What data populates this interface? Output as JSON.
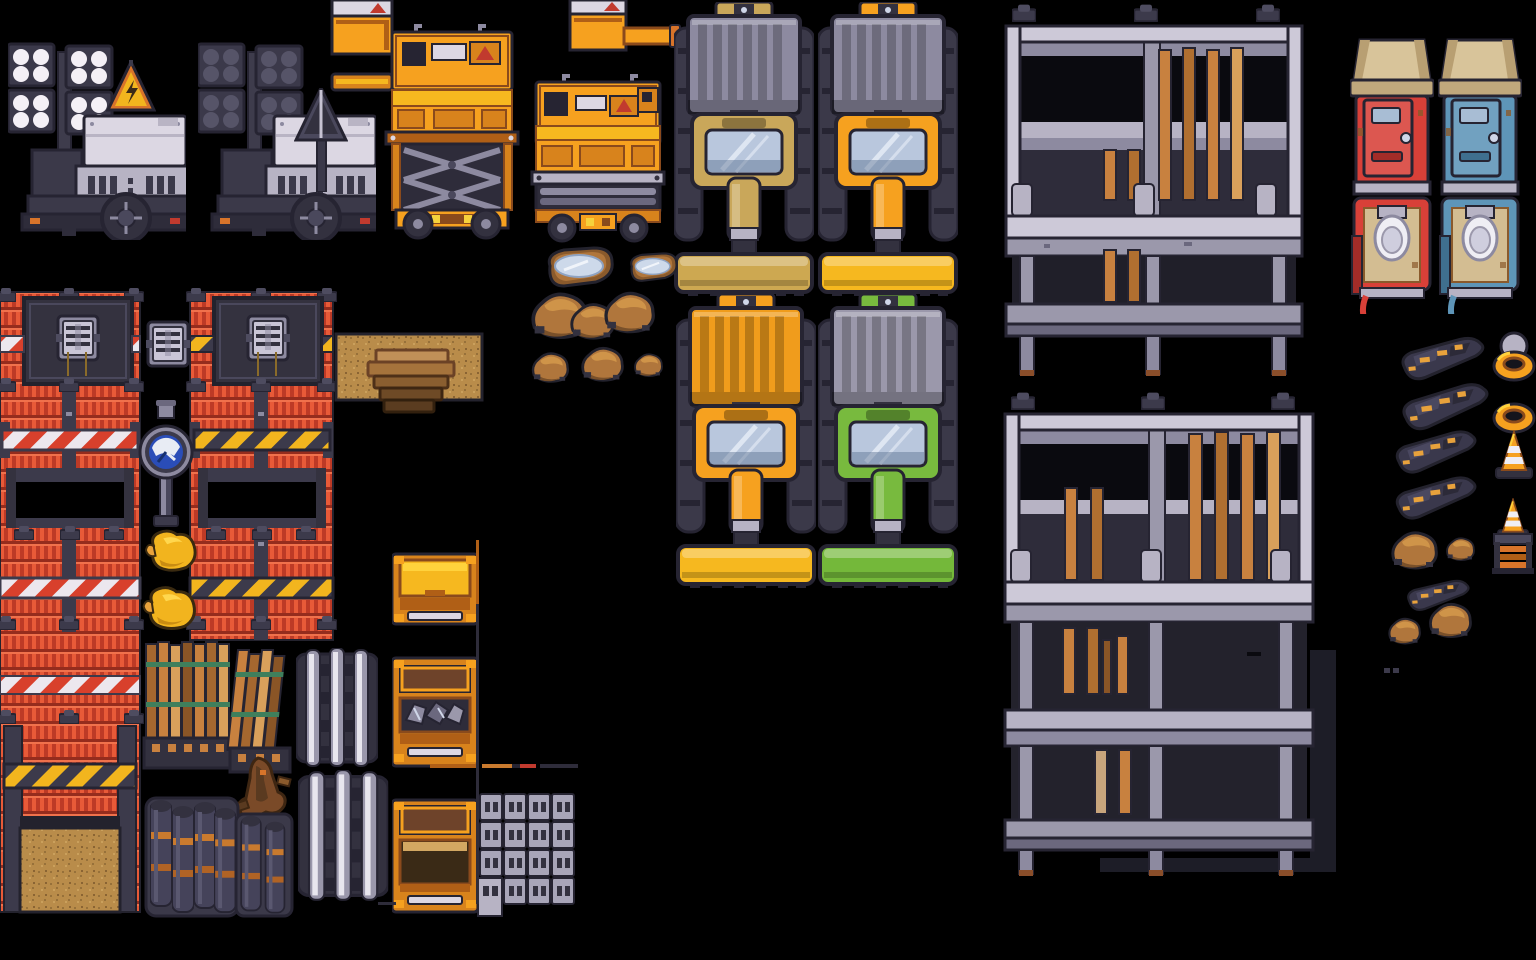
{
  "canvas": {
    "title": "construction-pixel-tileset",
    "description": "Top-down pixel-art construction tileset sprite sheet on black background",
    "width": 1536,
    "height": 960
  },
  "palette": {
    "bg": "#000000",
    "outline": "#262432",
    "navy": "#33313f",
    "navyMid": "#45435a",
    "steel": "#8d8aa0",
    "steelLight": "#c9c5d6",
    "white": "#e8e3ea",
    "orange": "#f6a11f",
    "orangeBright": "#f6b81f",
    "orangeDark": "#b05f16",
    "hazardYellow": "#f2b51e",
    "warningRed": "#c13a2e",
    "brickRed": "#da4530",
    "brickDark": "#952c1d",
    "toiletRed": "#d84038",
    "toiletBlue": "#5e95b8",
    "roofTan": "#d8c49a",
    "cabKhaki": "#c9a75a",
    "cabGreen": "#78ba3e",
    "glass": "#b9c7dd",
    "wood": "#c8813f",
    "woodLight": "#d9a05b",
    "woodDark": "#8a5526",
    "dirt": "#b98c4a",
    "mud": "#b0763c",
    "water": "#cdd9ea",
    "barrel": "#45435a",
    "rust": "#8a4e2a",
    "duckYellow": "#f2b41e",
    "shadow": "#1d1d27",
    "gaugeBlue": "#2a4db8"
  },
  "sprites": [
    {
      "id": "floodlight-lit",
      "label": "floodlight trailer, lights on, warning sign",
      "x": 8,
      "y": 38,
      "w": 178,
      "h": 202,
      "vars": {
        "lamp": "#f4f0f6"
      }
    },
    {
      "id": "floodlight-off",
      "label": "floodlight trailer, lights off, arrow mast",
      "x": 198,
      "y": 38,
      "w": 178,
      "h": 202,
      "vars": {
        "lamp": "#565468"
      }
    },
    {
      "id": "supply-box-a",
      "label": "orange supply box with warning label",
      "x": 332,
      "y": 0,
      "w": 60,
      "h": 54
    },
    {
      "id": "supply-bar-a",
      "label": "orange beam piece",
      "x": 332,
      "y": 74,
      "w": 60,
      "h": 16
    },
    {
      "id": "supply-box-b",
      "label": "orange supply box small",
      "x": 570,
      "y": 0,
      "w": 56,
      "h": 50
    },
    {
      "id": "crane-arm",
      "label": "orange crane arm piece",
      "x": 624,
      "y": 28,
      "w": 56,
      "h": 20
    },
    {
      "id": "scissor-extended",
      "label": "scissor lift extended",
      "x": 386,
      "y": 22,
      "w": 132,
      "h": 218
    },
    {
      "id": "scissor-collapsed",
      "label": "scissor lift collapsed",
      "x": 532,
      "y": 74,
      "w": 132,
      "h": 168
    },
    {
      "id": "truck-tan",
      "label": "plow truck khaki cab",
      "x": 674,
      "y": 2,
      "w": 140,
      "h": 296,
      "vars": {
        "cab": "#c9a75a",
        "bed": "#8d8aa0",
        "plow": "#cda851"
      }
    },
    {
      "id": "truck-orange-graybed",
      "label": "plow truck orange cab gray bed",
      "x": 818,
      "y": 2,
      "w": 140,
      "h": 296,
      "vars": {
        "cab": "#f6a11f",
        "bed": "#8d8aa0",
        "plow": "#f6b81f"
      }
    },
    {
      "id": "truck-orange",
      "label": "plow truck all orange",
      "x": 676,
      "y": 294,
      "w": 140,
      "h": 296,
      "vars": {
        "cab": "#f6a11f",
        "bed": "#f09c1c",
        "plow": "#f6b81f"
      }
    },
    {
      "id": "truck-green",
      "label": "plow truck green cab gray bed",
      "x": 818,
      "y": 294,
      "w": 140,
      "h": 296,
      "vars": {
        "cab": "#78ba3e",
        "bed": "#9b98ab",
        "plow": "#74b83a"
      }
    },
    {
      "id": "scaffold-a",
      "label": "scaffolding two level with planks",
      "x": 1004,
      "y": 4,
      "w": 300,
      "h": 375
    },
    {
      "id": "scaffold-b",
      "label": "scaffolding three level with planks and shadow",
      "x": 1003,
      "y": 392,
      "w": 340,
      "h": 486
    },
    {
      "id": "toilet-front-red",
      "label": "porta-potty front red",
      "x": 1350,
      "y": 38,
      "w": 84,
      "h": 162,
      "vars": {
        "shell": "#d84038",
        "shellDark": "#a32c28"
      }
    },
    {
      "id": "toilet-front-blue",
      "label": "porta-potty front blue",
      "x": 1438,
      "y": 38,
      "w": 84,
      "h": 162,
      "vars": {
        "shell": "#5e95b8",
        "shellDark": "#3f6f8e"
      }
    },
    {
      "id": "toilet-top-red",
      "label": "porta-potty interior red",
      "x": 1350,
      "y": 196,
      "w": 84,
      "h": 118,
      "vars": {
        "shell": "#d84038",
        "shellDark": "#a32c28"
      }
    },
    {
      "id": "toilet-top-blue",
      "label": "porta-potty interior blue",
      "x": 1438,
      "y": 196,
      "w": 84,
      "h": 118,
      "vars": {
        "shell": "#5e95b8",
        "shellDark": "#3f6f8e"
      }
    },
    {
      "id": "wall-left",
      "label": "red site wall left column with vent panel, stripes, window, dirt doorway",
      "x": 0,
      "y": 292,
      "w": 140,
      "h": 620
    },
    {
      "id": "wall-right",
      "label": "red site wall right column with vent panel, hazard stripes, window",
      "x": 190,
      "y": 292,
      "w": 143,
      "h": 348
    },
    {
      "id": "vent-unit",
      "label": "wall vent unit tile",
      "x": 146,
      "y": 316,
      "w": 44,
      "h": 54
    },
    {
      "id": "gauge-post",
      "label": "blue gauge on steel post",
      "x": 144,
      "y": 404,
      "w": 44,
      "h": 126
    },
    {
      "id": "duck-a",
      "label": "yellow rubber duck",
      "x": 144,
      "y": 524,
      "w": 54,
      "h": 52
    },
    {
      "id": "duck-b",
      "label": "yellow rubber duck",
      "x": 142,
      "y": 580,
      "w": 58,
      "h": 52,
      "rot": 3
    },
    {
      "id": "dirt-tile",
      "label": "dirt ground tile",
      "x": 336,
      "y": 334,
      "w": 146,
      "h": 66
    },
    {
      "id": "wood-steps",
      "label": "wooden steps",
      "x": 364,
      "y": 348,
      "w": 90,
      "h": 66
    },
    {
      "id": "lumber-a",
      "label": "lumber plank bundle",
      "x": 146,
      "y": 642,
      "w": 88,
      "h": 126
    },
    {
      "id": "lumber-b",
      "label": "leaning lumber bundle",
      "x": 230,
      "y": 650,
      "w": 62,
      "h": 122
    },
    {
      "id": "stump",
      "label": "root stump debris",
      "x": 234,
      "y": 758,
      "w": 60,
      "h": 66
    },
    {
      "id": "beams-a",
      "label": "steel beam stack",
      "x": 296,
      "y": 648,
      "w": 82,
      "h": 120
    },
    {
      "id": "beams-b",
      "label": "steel beam stack tall",
      "x": 298,
      "y": 770,
      "w": 84,
      "h": 146,
      "scale": 1.1
    },
    {
      "id": "barrels-a",
      "label": "barrel cluster large",
      "x": 148,
      "y": 796,
      "w": 88,
      "h": 120
    },
    {
      "id": "barrels-b",
      "label": "barrel cluster small",
      "x": 238,
      "y": 812,
      "w": 52,
      "h": 104
    },
    {
      "id": "dumpster-open",
      "label": "orange dumpster open",
      "x": 392,
      "y": 550,
      "w": 86,
      "h": 78
    },
    {
      "id": "dumpster-scrap",
      "label": "orange dumpster with scrap",
      "x": 392,
      "y": 654,
      "w": 86,
      "h": 116
    },
    {
      "id": "dumpster-lid",
      "label": "orange dumpster with lid",
      "x": 392,
      "y": 798,
      "w": 86,
      "h": 118
    },
    {
      "id": "pallet",
      "label": "cinder block pallet",
      "x": 478,
      "y": 794,
      "w": 98,
      "h": 122
    },
    {
      "id": "puddle-a",
      "label": "mud puddle large",
      "x": 542,
      "y": 246,
      "w": 72,
      "h": 42
    },
    {
      "id": "puddle-b",
      "label": "mud puddle small",
      "x": 626,
      "y": 252,
      "w": 46,
      "h": 36,
      "scale": 0.72
    },
    {
      "id": "boulders",
      "label": "boulder cluster",
      "x": 526,
      "y": 284,
      "w": 124,
      "h": 54
    },
    {
      "id": "rock-a",
      "label": "small rock",
      "x": 526,
      "y": 348,
      "scale": 0.92
    },
    {
      "id": "rock-b",
      "label": "small rock",
      "x": 576,
      "y": 342,
      "scale": 1.0
    },
    {
      "id": "rock-c",
      "label": "small rock",
      "x": 632,
      "y": 350,
      "scale": 0.62
    },
    {
      "id": "debris-1",
      "label": "dark rubble streak",
      "x": 1398,
      "y": 344,
      "rot": -6
    },
    {
      "id": "debris-2",
      "label": "dark rubble streak",
      "x": 1398,
      "y": 392,
      "rot": -8
    },
    {
      "id": "debris-3",
      "label": "dark rubble streak",
      "x": 1392,
      "y": 438,
      "rot": -7
    },
    {
      "id": "debris-4",
      "label": "dark rubble streak",
      "x": 1392,
      "y": 484,
      "rot": -7
    },
    {
      "id": "debris-5",
      "label": "dark rubble streak",
      "x": 1394,
      "y": 584,
      "rot": -4
    },
    {
      "id": "mound-1",
      "label": "dirt mound",
      "x": 1388,
      "y": 526
    },
    {
      "id": "mound-2",
      "label": "dirt mound small",
      "x": 1444,
      "y": 534,
      "scale": 0.62
    },
    {
      "id": "mound-3",
      "label": "dirt mound",
      "x": 1426,
      "y": 598,
      "scale": 0.92
    },
    {
      "id": "mound-4",
      "label": "dirt mound small",
      "x": 1386,
      "y": 614,
      "scale": 0.7
    },
    {
      "id": "ring-domed",
      "label": "ring light with dome",
      "x": 1492,
      "y": 330
    },
    {
      "id": "ring-plain",
      "label": "ring light",
      "x": 1492,
      "y": 382
    },
    {
      "id": "cone",
      "label": "traffic cone",
      "x": 1494,
      "y": 430
    },
    {
      "id": "cone-stand",
      "label": "traffic cone on slat stand",
      "x": 1490,
      "y": 498
    },
    {
      "id": "line-h",
      "label": "thin beam fragments horizontal",
      "x": 430,
      "y": 764
    },
    {
      "id": "line-v",
      "label": "thin beam fragment vertical",
      "x": 476,
      "y": 540
    },
    {
      "id": "line-joint",
      "label": "thin connector fragment",
      "x": 378,
      "y": 902
    },
    {
      "id": "specks",
      "label": "tiny debris specks",
      "x": 1384,
      "y": 668
    }
  ]
}
